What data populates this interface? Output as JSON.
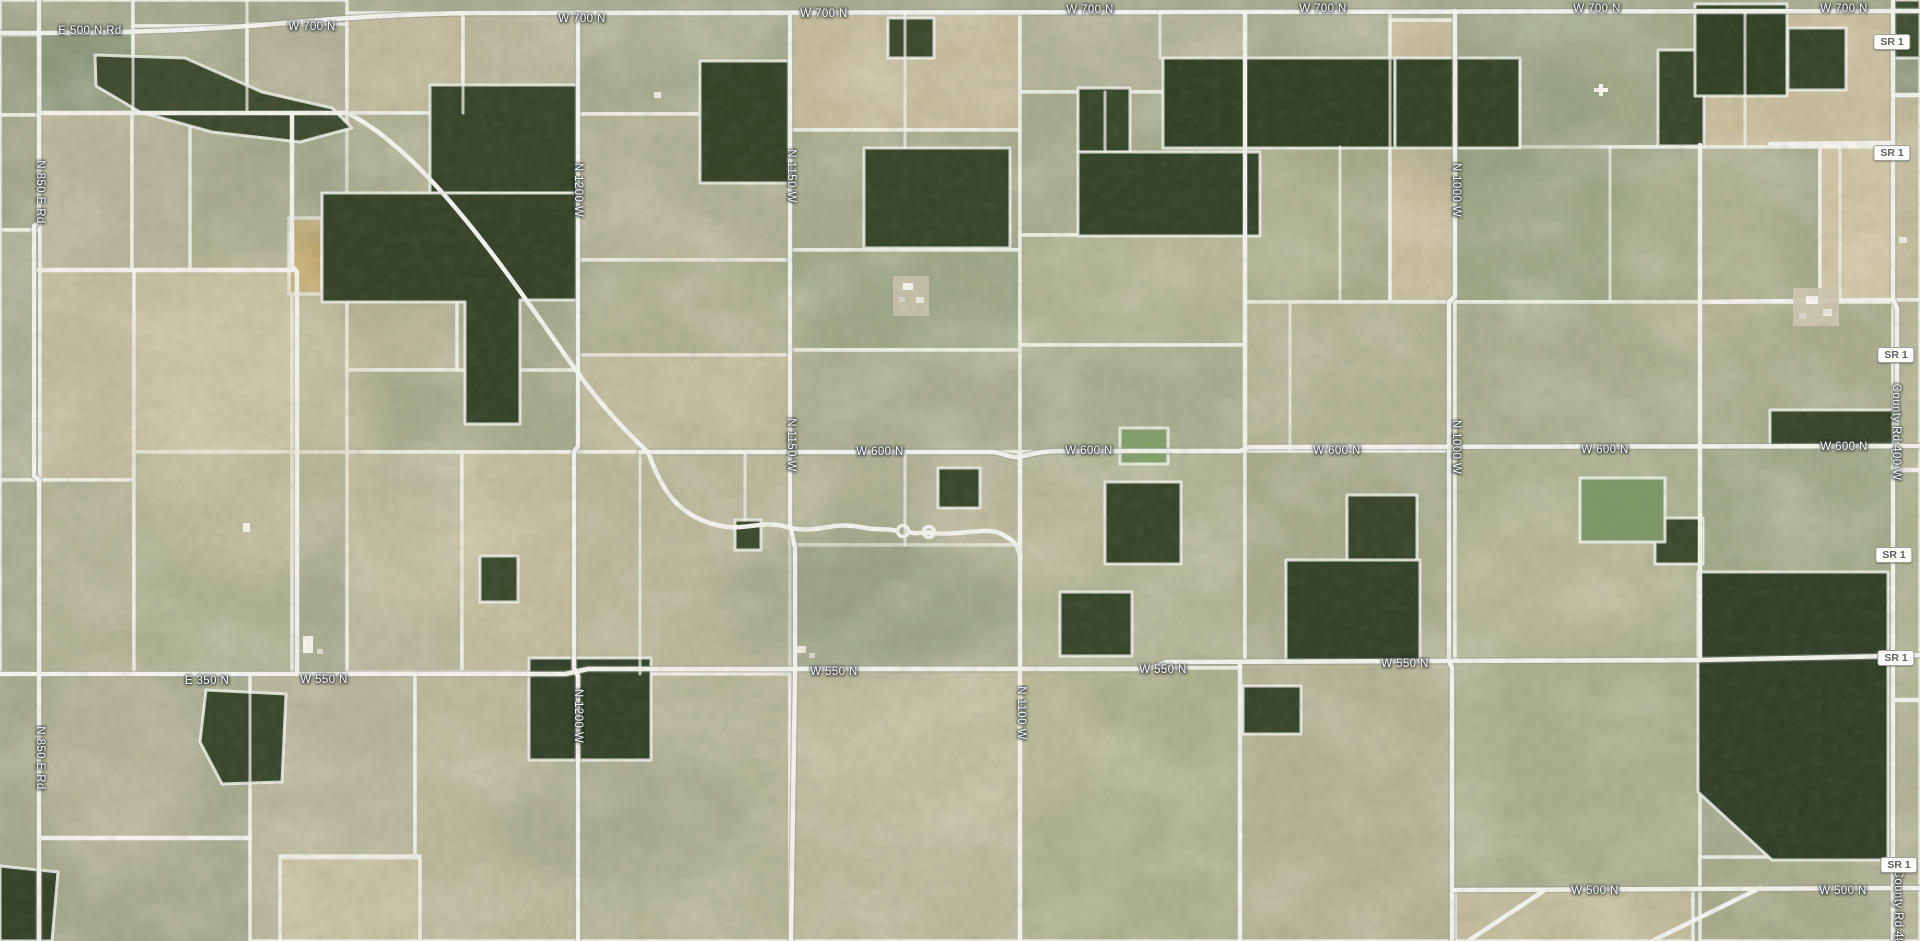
{
  "map": {
    "description": "Satellite aerial view of rural farmland with white parcel-boundary overlay and county road labels",
    "road_labels": [
      {
        "text": "E 500 N Rd",
        "x": 90,
        "y": 31,
        "rot": 0
      },
      {
        "text": "W 700 N",
        "x": 312,
        "y": 27,
        "rot": 0
      },
      {
        "text": "W 700 N",
        "x": 582,
        "y": 19,
        "rot": 0
      },
      {
        "text": "W 700 N",
        "x": 824,
        "y": 14,
        "rot": 0
      },
      {
        "text": "W 700 N",
        "x": 1090,
        "y": 10,
        "rot": 0
      },
      {
        "text": "W 700 N",
        "x": 1323,
        "y": 9,
        "rot": 0
      },
      {
        "text": "W 700 N",
        "x": 1597,
        "y": 9,
        "rot": 0
      },
      {
        "text": "W 700 N",
        "x": 1844,
        "y": 9,
        "rot": 0
      },
      {
        "text": "W 600 N",
        "x": 880,
        "y": 452,
        "rot": 0
      },
      {
        "text": "W 600 N",
        "x": 1089,
        "y": 451,
        "rot": 0
      },
      {
        "text": "W 600 N",
        "x": 1337,
        "y": 451,
        "rot": 0
      },
      {
        "text": "W 600 N",
        "x": 1605,
        "y": 450,
        "rot": 0
      },
      {
        "text": "W 600 N",
        "x": 1844,
        "y": 447,
        "rot": 0
      },
      {
        "text": "E 350 N",
        "x": 207,
        "y": 681,
        "rot": 0
      },
      {
        "text": "W 550 N",
        "x": 324,
        "y": 680,
        "rot": 0
      },
      {
        "text": "W 550 N",
        "x": 834,
        "y": 672,
        "rot": 0
      },
      {
        "text": "W 550 N",
        "x": 1163,
        "y": 670,
        "rot": 0
      },
      {
        "text": "W 550 N",
        "x": 1405,
        "y": 664,
        "rot": 0
      },
      {
        "text": "W 500 N",
        "x": 1595,
        "y": 891,
        "rot": 0
      },
      {
        "text": "W 500 N",
        "x": 1843,
        "y": 891,
        "rot": 0
      },
      {
        "text": "N 850 E Rd",
        "x": 40,
        "y": 192,
        "rot": 90
      },
      {
        "text": "N 850 E Rd",
        "x": 40,
        "y": 758,
        "rot": 90
      },
      {
        "text": "N 1200 W",
        "x": 578,
        "y": 190,
        "rot": 90
      },
      {
        "text": "N 1200 W",
        "x": 578,
        "y": 716,
        "rot": 90
      },
      {
        "text": "N 1150 W",
        "x": 791,
        "y": 176,
        "rot": 90
      },
      {
        "text": "N 1150 W",
        "x": 791,
        "y": 445,
        "rot": 90
      },
      {
        "text": "N 1100 W",
        "x": 1021,
        "y": 713,
        "rot": 90
      },
      {
        "text": "N 1000 W",
        "x": 1456,
        "y": 190,
        "rot": 90
      },
      {
        "text": "N 1000 W",
        "x": 1456,
        "y": 447,
        "rot": 90
      },
      {
        "text": "County Rd 400 W",
        "x": 1896,
        "y": 432,
        "rot": 90
      },
      {
        "text": "County Rd 400 W",
        "x": 1898,
        "y": 918,
        "rot": 90
      }
    ],
    "route_badges": [
      {
        "text": "SR 1",
        "x": 1892,
        "y": 42
      },
      {
        "text": "SR 1",
        "x": 1892,
        "y": 153
      },
      {
        "text": "SR 1",
        "x": 1896,
        "y": 355
      },
      {
        "text": "SR 1",
        "x": 1894,
        "y": 555
      },
      {
        "text": "SR 1",
        "x": 1896,
        "y": 658
      },
      {
        "text": "SR 1",
        "x": 1899,
        "y": 865
      }
    ],
    "colors": {
      "label_text": "#ffffff",
      "label_halo": "#1e2428",
      "badge_background": "#fdfdfa",
      "badge_border": "#9fa09a",
      "badge_text": "#5d6065",
      "road_line": "#f1f2ec",
      "forest": "#36442a",
      "field_tan": "#c2bb9d",
      "field_sage": "#a6aa8e"
    }
  }
}
